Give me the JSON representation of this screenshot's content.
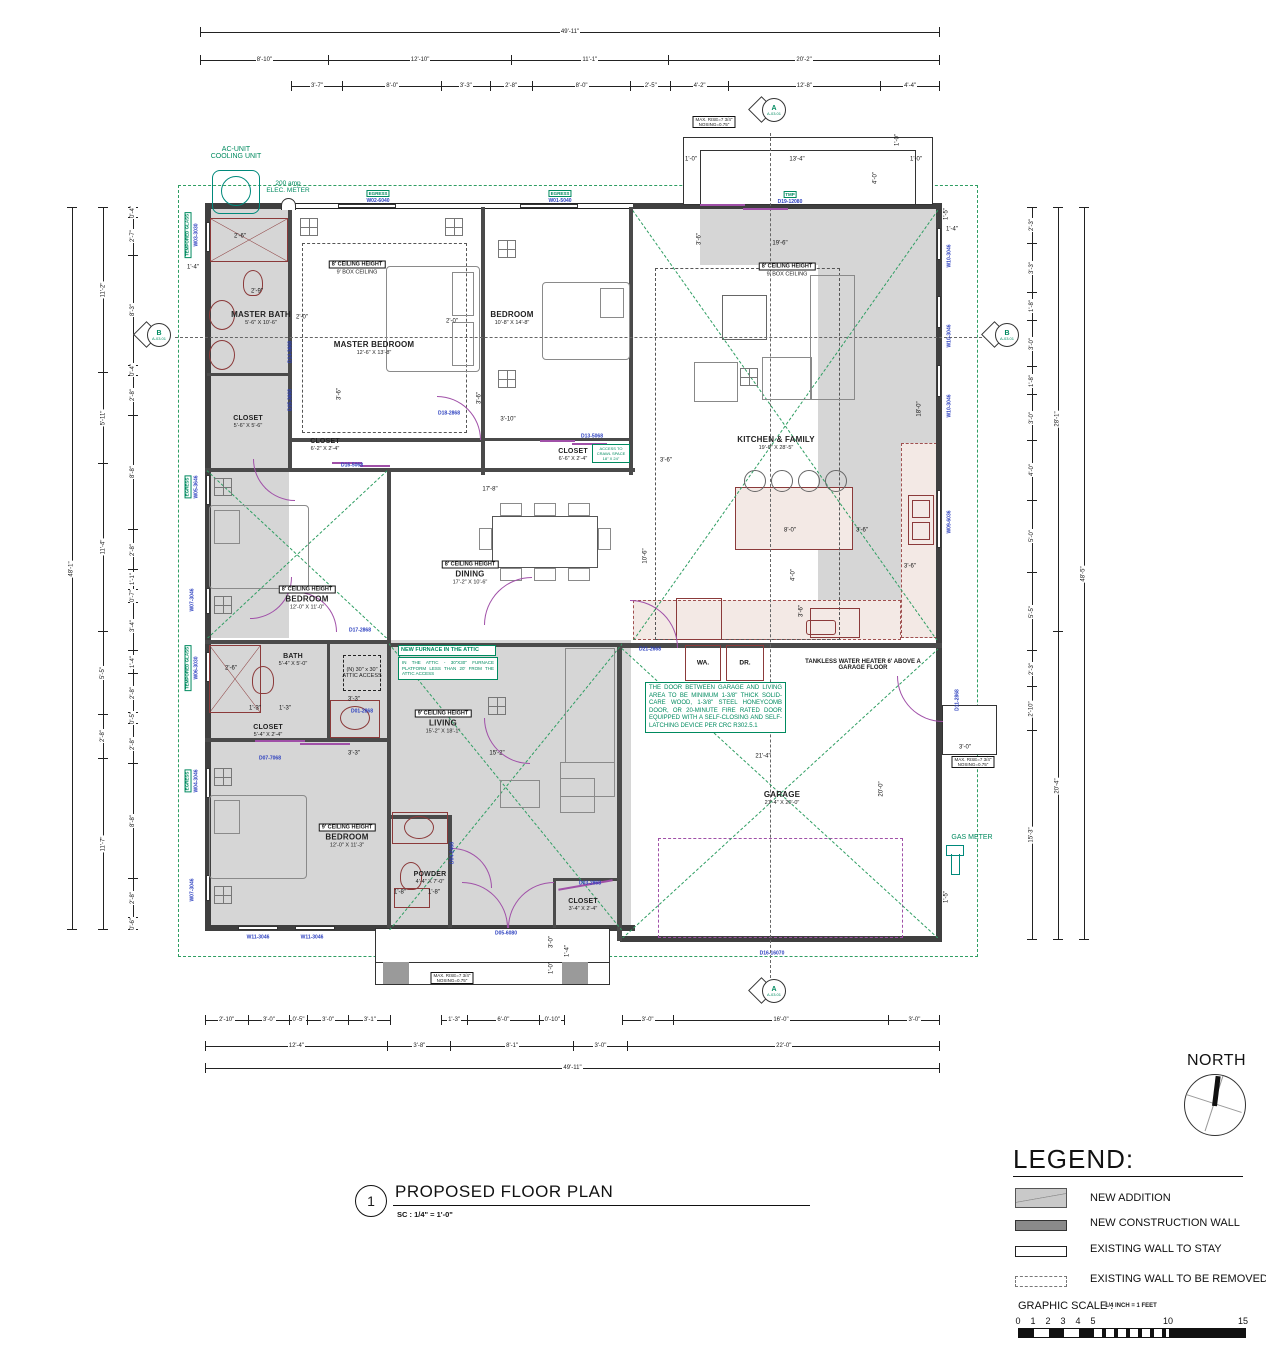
{
  "title_block": {
    "number": "1",
    "title": "PROPOSED FLOOR PLAN",
    "scale": "SC : 1/4\" = 1'-0\""
  },
  "north": {
    "label": "NORTH"
  },
  "legend": {
    "title": "LEGEND:",
    "items": [
      {
        "label": "NEW ADDITION"
      },
      {
        "label": "NEW CONSTRUCTION WALL"
      },
      {
        "label": "EXISTING WALL TO STAY"
      },
      {
        "label": "EXISTING WALL TO BE REMOVED"
      }
    ],
    "graphic_scale": {
      "label": "GRAPHIC SCALE :",
      "note": "1/4 INCH = 1 FEET",
      "ticks": [
        "0",
        "1",
        "2",
        "3",
        "4",
        "5",
        "10",
        "15"
      ]
    }
  },
  "markers": {
    "a": "A",
    "b": "B",
    "sheet": "A-03.01"
  },
  "rooms": {
    "master_bath": {
      "name": "MASTER BATH",
      "size": "5'-6\" X 10'-6\""
    },
    "master_bedroom": {
      "name": "MASTER BEDROOM",
      "size": "12'-6\" X 13'-8\""
    },
    "bedroom_top": {
      "name": "BEDROOM",
      "size": "10'-8\" X 14'-8\""
    },
    "kitchen_family": {
      "name": "KITCHEN & FAMILY",
      "size": "19'-6\" X 28'-5\""
    },
    "closet_master": {
      "name": "CLOSET",
      "size": "5'-6\" X 5'-6\""
    },
    "closet_hall1": {
      "name": "CLOSET",
      "size": "6'-2\" X 2'-4\""
    },
    "closet_hall2": {
      "name": "CLOSET",
      "size": "6'-6\" X 2'-4\""
    },
    "dining": {
      "name": "DINING",
      "size": "17'-2\" X 10'-6\""
    },
    "bedroom_mid": {
      "name": "BEDROOM",
      "size": "12'-0\" X 11'-0\""
    },
    "bath": {
      "name": "BATH",
      "size": "5'-4\" X 5'-0\""
    },
    "closet_bath": {
      "name": "CLOSET",
      "size": "5'-4\" X 2'-4\""
    },
    "living": {
      "name": "LIVING",
      "size": "15'-2\" X 18'-1\""
    },
    "bedroom_bottom": {
      "name": "BEDROOM",
      "size": "12'-0\" X 11'-3\""
    },
    "powder": {
      "name": "POWDER",
      "size": "4'-4\" X 7'-0\""
    },
    "closet_entry": {
      "name": "CLOSET",
      "size": "3'-4\" X 2'-4\""
    },
    "garage": {
      "name": "GARAGE",
      "size": "21'-4\" X 20'-0\""
    },
    "washer": "WA.",
    "dryer": "DR."
  },
  "ceiling": {
    "h8": "8' CEILING HEIGHT",
    "box9": "9' BOX CEILING",
    "h9": "9' CEILING HEIGHT"
  },
  "notes": {
    "ac_unit": "AC-UNIT\nCOOLING UNIT",
    "elec": "200 amp\nELEC. METER",
    "gas": "GAS METER",
    "tmp": "TMP",
    "egress": "EGRESS",
    "tempored": "TEMPORED GLASS",
    "tankless": "TANKLESS WATER HEATER 6' ABOVE A\nGARAGE FLOOR",
    "garage_door": "THE DOOR BETWEEN GARAGE AND LIVING AREA TO BE MINIMUM 1-3/8\" THICK SOLID-CARE WOOD, 1-3/8\" STEEL HONEYCOMB DOOR, OR 20-MINUTE FIRE RATED DOOR EQUIPPED WITH A SELF-CLOSING AND SELF-LATCHING DEVICE PER CRC R302.5.1",
    "furnace_title": "NEW FURNACE IN THE ATTIC",
    "furnace_body": "IN THE ATTIC - 30\"X30\" FURNACE PLATFORM LESS THAN 20' FROM THE ATTIC ACCESS",
    "attic_access": "(N) 30\" x 30\"\nATTIC ACCESS",
    "crawl": "ACCESS TO\nCRAWL SPACE\n18\" X 24\"",
    "max_rise": "MAX. RISE=7 3/4\"\nNOSING=0.75\""
  },
  "dims": {
    "top": {
      "row1": [
        "49'-11\""
      ],
      "row2": [
        "8'-10\"",
        "12'-10\"",
        "11'-1\"",
        "20'-2\""
      ],
      "row3": [
        "3'-7\"",
        "8'-0\"",
        "3'-3\"",
        "2'-8\"",
        "8'-0\"",
        "2'-5\"",
        "4'-2\"",
        "12'-8\"",
        "4'-4\""
      ]
    },
    "bottom": {
      "rowA": [
        "2'-10\"",
        "3'-0\"",
        "0'-5\"",
        "3'-0\"",
        "3'-1\""
      ],
      "rowB": [
        "1'-3\"",
        "6'-0\"",
        "0'-10\""
      ],
      "rowC": [
        "3'-0\"",
        "16'-0\"",
        "3'-0\""
      ],
      "row2": [
        "12'-4\"",
        "3'-8\"",
        "8'-1\"",
        "3'-0\"",
        "22'-0\""
      ],
      "row3": [
        "49'-11\""
      ]
    },
    "left": {
      "outer": [
        "48'-1\""
      ],
      "mid": [
        "11'-2\"",
        "5'-11\"",
        "11'-4\"",
        "5'-5\"",
        "2'-8\"",
        "11'-7\""
      ],
      "inner": [
        "0'-4\"",
        "2'-7\"",
        "8'-3\"",
        "0'-4\"",
        "2'-8\"",
        "8'-8\"",
        "2'-8\"",
        "1'-1\"",
        "0'-7\"",
        "3'-4\"",
        "1'-4\"",
        "2'-8\"",
        "0'-5\"",
        "2'-8\"",
        "8'-8\"",
        "2'-8\"",
        "0'-6\""
      ]
    },
    "right": {
      "inner": [
        "2'-3\"",
        "3'-3\"",
        "1'-8\"",
        "3'-0\"",
        "1'-8\"",
        "3'-0\"",
        "4'-0\"",
        "5'-0\"",
        "5'-5\"",
        "2'-3\"",
        "2'-10\"",
        "15'-3\""
      ],
      "mid": [
        "28'-1\"",
        "20'-4\""
      ],
      "outer": [
        "48'-5\""
      ]
    }
  },
  "idims": [
    "2'-6\"",
    "2'-9\"",
    "2'-0\"",
    "2'-0\"",
    "3'-6\"",
    "3'-10\"",
    "3'-6\"",
    "17'-8\"",
    "10'-6\"",
    "19'-6\"",
    "3'-6\"",
    "18'-0\"",
    "8'-0\"",
    "3'-6\"",
    "4'-0\"",
    "3'-6\"",
    "3'-6\"",
    "21'-4\"",
    "20'-0\"",
    "15'-2\"",
    "3'-3\"",
    "3'-3\"",
    "1'-8\"",
    "1'-8\"",
    "2'-6\"",
    "1'-3\"",
    "1'-3\"",
    "13'-4\"",
    "1'-0\"",
    "1'-0\"",
    "1'-0\"",
    "4'-0\"",
    "3'-0\"",
    "1'-0\"",
    "1'-4\"",
    "3'-0\"",
    "1'-5\"",
    "1'-4\"",
    "1'-5\"",
    "1'-4\"",
    "3'-6\""
  ],
  "door_labels": [
    "D14-3668",
    "D15-3668",
    "D16-5068",
    "D13-5068",
    "D18-2868",
    "D17-2868",
    "D01-2868",
    "D21-2668",
    "D07-7068",
    "D04-2468",
    "D03-2868",
    "D05-6080",
    "D11-2868",
    "D16-16070",
    "D19-12080"
  ],
  "window_labels": {
    "top": [
      "W02-6040",
      "W01-5040"
    ],
    "left": [
      "W03-3030",
      "W05-3646",
      "W07-3046",
      "W06-3030",
      "W04-3046",
      "W07-3046"
    ],
    "right": [
      "W10-3046",
      "W10-3046",
      "W10-3046",
      "W09-6036"
    ],
    "bottom": [
      "W11-3046",
      "W11-3046"
    ]
  }
}
